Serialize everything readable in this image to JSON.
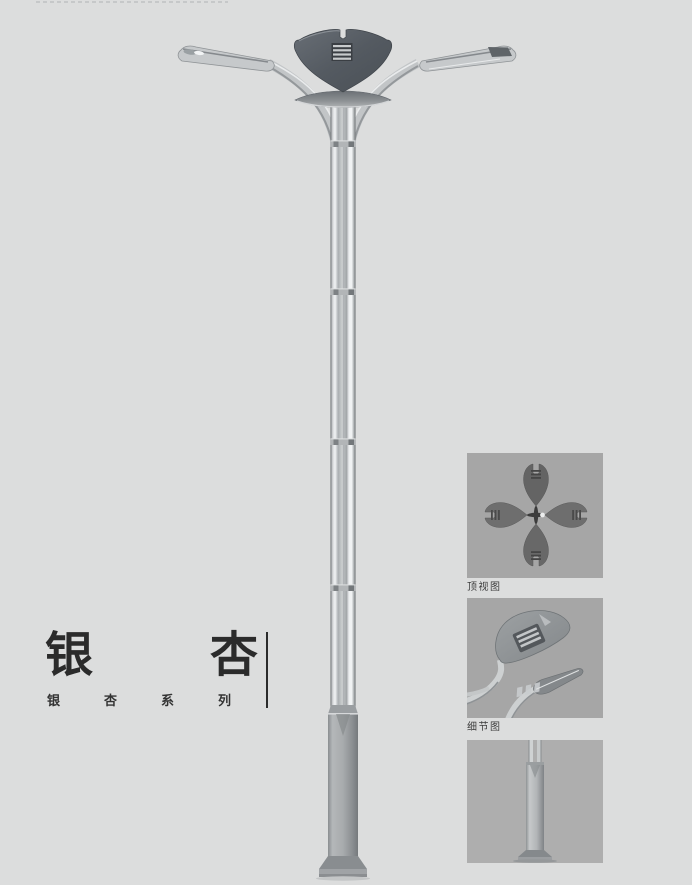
{
  "title": {
    "main": {
      "chars": [
        "银",
        "杏"
      ]
    },
    "series": {
      "chars": [
        "银",
        "杏",
        "系",
        "列"
      ]
    }
  },
  "gallery": {
    "panels": [
      {
        "id": "top-view",
        "caption": "顶视图"
      },
      {
        "id": "detail-view",
        "caption": "细节图"
      },
      {
        "id": "base-view",
        "caption": ""
      }
    ]
  },
  "illustration": {
    "subject": "ginkgo-street-lamp"
  },
  "colors": {
    "page_bg": "#dcdddd",
    "panel_bg": "#a6a6a6",
    "panel_base_bg": "#aeaeae",
    "title_text": "#2b2b2b",
    "caption_text": "#3c3c3c",
    "crown_dark": "#585d63",
    "metal_light": "#eceeef",
    "metal_mid": "#b7babc"
  }
}
